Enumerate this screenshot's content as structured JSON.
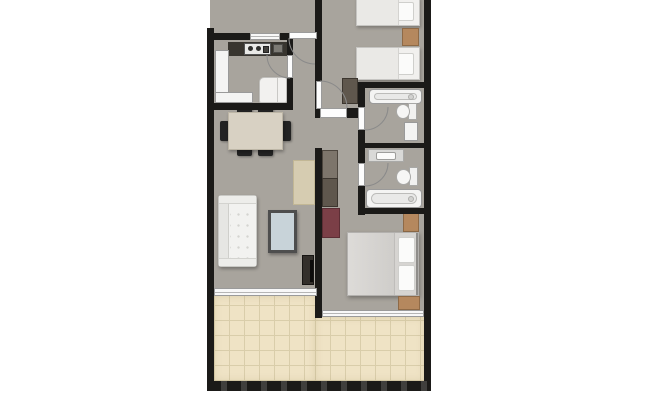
{
  "page": {
    "description": "Top-down 2D rendered architectural floor plan of an apartment, cropped at the top edge; white page background; no visible text labels",
    "background": "#ffffff"
  },
  "palette": {
    "page": "#ffffff",
    "floor": "#a8a49d",
    "wall": "#1b1a18",
    "tile": "#efe3c5",
    "tile-line": "#d9cdaa",
    "fw": "#f4f4f3",
    "fb": "#9a9a9a",
    "counter-dark": "#38352f",
    "wood-light": "#d8d1c3",
    "wood-brown": "#b5885e",
    "wgray": "#5f574d",
    "wgray-light": "#7d756b",
    "maroon": "#7b3f47",
    "ttop": "#c8d3d9",
    "tv": "#332f2b",
    "arc": "#8a8a8a",
    "win": "#f8f8f8",
    "duvet": "#d6d4d1",
    "sofa": "#f2f2f0",
    "console": "#d6ccb1"
  },
  "rooms": [
    {
      "name": "adjacent-room-cropped",
      "note": "gray floor strip cut off by top edge"
    },
    {
      "name": "entry-hall"
    },
    {
      "name": "kitchen"
    },
    {
      "name": "dining-area"
    },
    {
      "name": "living-room"
    },
    {
      "name": "corridor-dressing"
    },
    {
      "name": "bedroom-1",
      "note": "two single beds, cropped at top"
    },
    {
      "name": "bathroom-1",
      "note": "bathtub, toilet, cabinet"
    },
    {
      "name": "bathroom-2",
      "note": "vanity sink, toilet, bathtub"
    },
    {
      "name": "bedroom-2",
      "note": "double bed with two nightstands"
    },
    {
      "name": "terrace",
      "note": "L-shaped balcony with cream floor tiles"
    }
  ],
  "furniture": [
    "kitchen-counter-dark-with-stove",
    "kitchen-sink",
    "kitchen-counter-left",
    "kitchen-counter-bottom",
    "fridge",
    "dining-table",
    "dining-chairs-x6",
    "sofa",
    "coffee-table",
    "console-sideboard",
    "tv-unit",
    "wardrobe-corridor",
    "dresser-maroon",
    "single-bed-1",
    "single-bed-2",
    "nightstand-bedroom-1",
    "wardrobe-bedroom-1",
    "bathtub-1",
    "toilet-1",
    "bath-cabinet-1",
    "vanity-sink-2",
    "toilet-2",
    "bathtub-2",
    "double-bed",
    "nightstand-top",
    "nightstand-bottom"
  ],
  "doors": [
    {
      "name": "entrance-door",
      "swing": "into hall"
    },
    {
      "name": "kitchen-door",
      "swing": "into kitchen"
    },
    {
      "name": "bedroom-1-door",
      "swing": "into bedroom"
    },
    {
      "name": "bathroom-1-door",
      "swing": "into bathroom"
    },
    {
      "name": "bathroom-2-door",
      "swing": "into bathroom"
    }
  ],
  "windows": [
    "kitchen-window",
    "living-room-terrace-window",
    "bedroom-2-terrace-window"
  ]
}
